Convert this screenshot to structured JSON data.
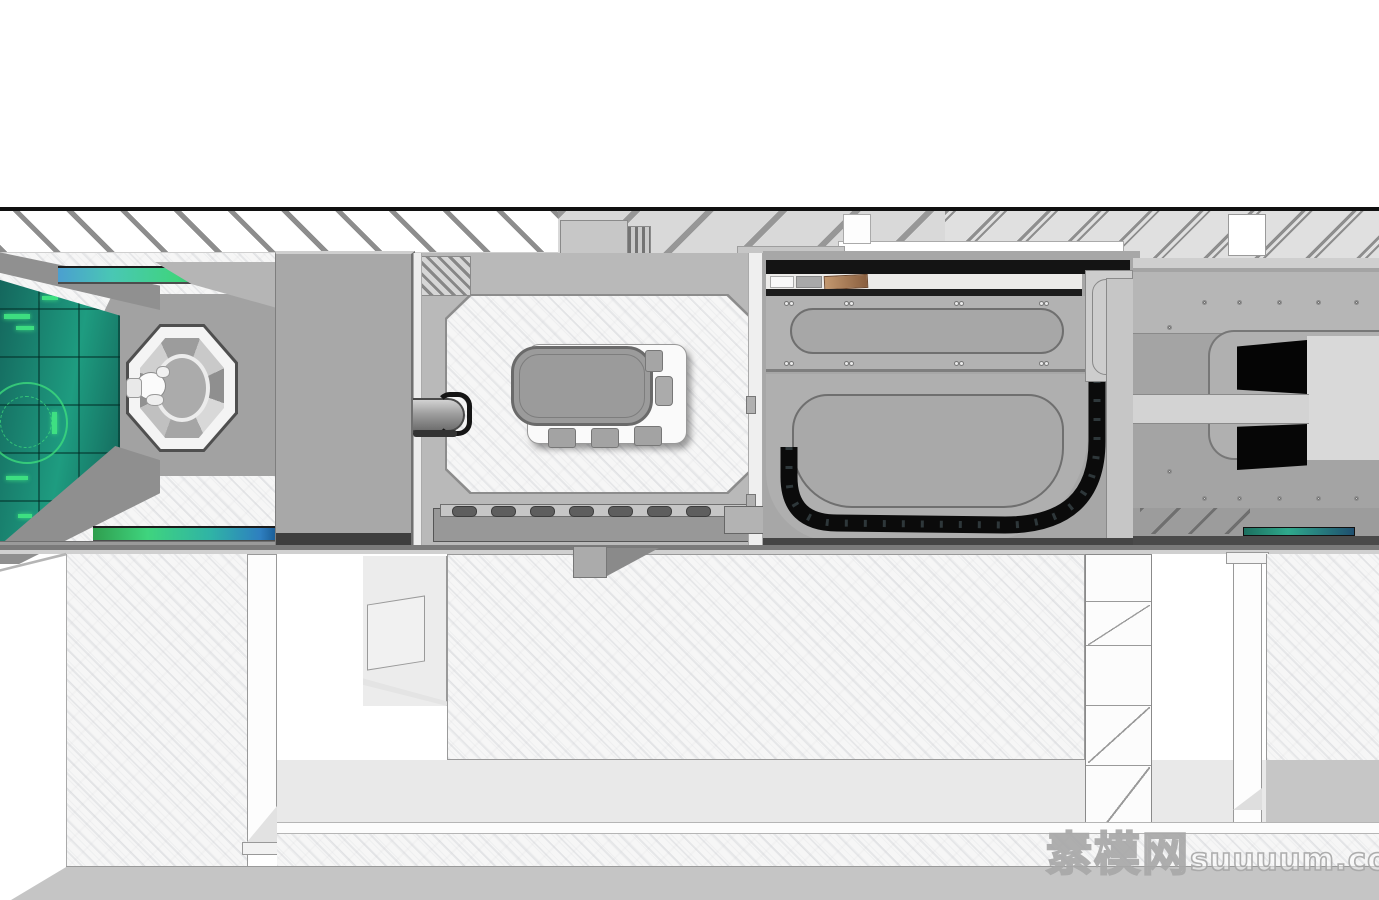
{
  "watermark": {
    "brand": "素模网",
    "site": "suuuum.com"
  },
  "colors": {
    "line_black": "#101010",
    "metal_mid": "#a8a8a8",
    "metal_panel": "#b2b2b2",
    "metal_dark_band": "#141414",
    "screen_teal_dark": "#14655c",
    "screen_teal": "#1e9c80",
    "screen_glow_green": "#42e983",
    "glass_blue": "#4b9fd0",
    "glass_green": "#3fd47e",
    "tan_card": "#c3986f",
    "floor_grey": "#c5c5c5",
    "watermark_stroke": "#a8a8a8"
  }
}
